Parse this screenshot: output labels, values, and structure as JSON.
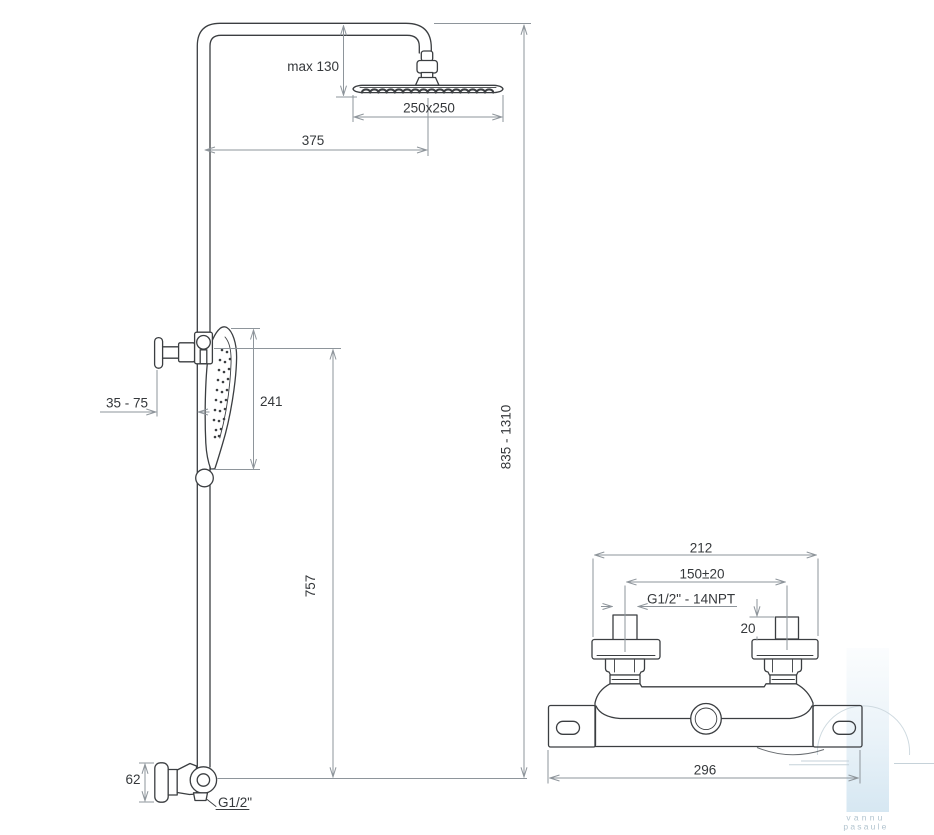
{
  "drawing": {
    "type": "technical-dimension-drawing",
    "views": {
      "shower_column": {
        "label": "shower column side view",
        "dims": {
          "head_drop": "max 130",
          "head_size": "250x250",
          "arm_reach": "375",
          "wall_offset": "35 - 75",
          "handset_length": "241",
          "riser_height": "757",
          "overall_height": "835 - 1310",
          "elbow_offset": "62",
          "inlet_thread": "G1/2\""
        }
      },
      "mixer": {
        "label": "thermostatic mixer front view",
        "dims": {
          "flange_span": "212",
          "inlet_centers": "150±20",
          "inlet_thread": "G1/2\" - 14NPT",
          "stub_length": "20",
          "overall_width": "296"
        }
      }
    },
    "colors": {
      "outline": "#3b3e41",
      "dimension": "#8e959b",
      "label_text": "#35383b",
      "watermark_blue": "#cfe3f0",
      "watermark_text": "#b2c4cf"
    }
  },
  "watermark": {
    "line1": "vannu",
    "line2": "pasaule"
  }
}
